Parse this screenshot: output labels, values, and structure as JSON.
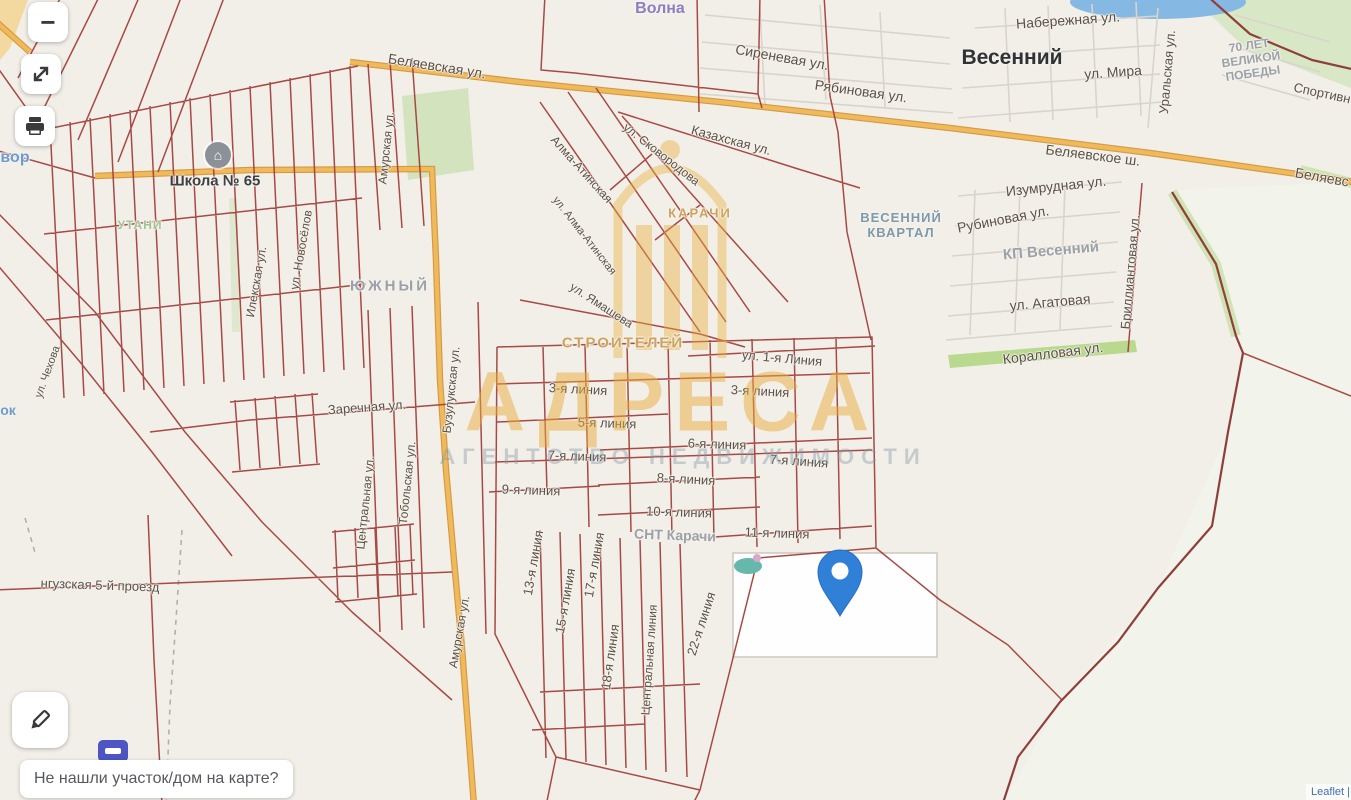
{
  "controls": {
    "zoom_out_label": "−",
    "icons": {
      "zoom_out": "minus-icon",
      "expand": "diagonal-resize-arrows-icon",
      "print": "printer-icon",
      "edit": "pencil-icon",
      "marker": "map-pin-icon",
      "school": "building-icon",
      "bus_stop": "bus-stop-icon"
    }
  },
  "footer": {
    "question": "Не нашли участок/дом на карте?"
  },
  "attribution": {
    "text": "Leaflet |"
  },
  "watermark": {
    "title": "АДРЕСА",
    "subtitle": "АГЕНТСТВО НЕДВИЖИМОСТИ"
  },
  "colors": {
    "pin": "#2f80d6",
    "road_primary": "#f0b95c",
    "parcel_line": "#a2403c",
    "boundary_line": "#8f3f3a",
    "water": "#85b8e2",
    "watermark_orange": "#e9ae38",
    "background": "#f2efe9"
  },
  "map": {
    "labels": [
      {
        "t": "Волна",
        "x": 660,
        "y": 9,
        "s": 16,
        "c": "purple",
        "n": "place-label"
      },
      {
        "t": "Весенний",
        "x": 1012,
        "y": 58,
        "s": 21,
        "c": "big",
        "n": "district-label"
      },
      {
        "t": "Набережная ул.",
        "x": 1068,
        "y": 20,
        "s": 14,
        "r": -4,
        "c": "st"
      },
      {
        "t": "ул. Мира",
        "x": 1113,
        "y": 72,
        "s": 14,
        "r": -4,
        "c": "st"
      },
      {
        "t": "Уральская ул.",
        "x": 1168,
        "y": 72,
        "s": 13,
        "r": -85,
        "c": "st"
      },
      {
        "t": "70 ЛЕТ\nВЕЛИКОЙ\nПОБЕДЫ",
        "x": 1251,
        "y": 60,
        "s": 12,
        "r": -8,
        "c": "gray",
        "n": "district-label"
      },
      {
        "t": "Спортивн",
        "x": 1322,
        "y": 94,
        "s": 13,
        "r": 12,
        "c": "st"
      },
      {
        "t": "Беляевская ул.",
        "x": 437,
        "y": 66,
        "s": 14,
        "r": 9,
        "c": "st"
      },
      {
        "t": "Сиреневая ул.",
        "x": 782,
        "y": 57,
        "s": 14,
        "r": 10,
        "c": "st"
      },
      {
        "t": "Рябиновая ул.",
        "x": 861,
        "y": 91,
        "s": 14,
        "r": 8,
        "c": "st"
      },
      {
        "t": "Казахская ул.",
        "x": 731,
        "y": 141,
        "s": 13,
        "r": 15,
        "c": "st"
      },
      {
        "t": "ул. Сковородова",
        "x": 661,
        "y": 155,
        "s": 12,
        "r": 38,
        "c": "st"
      },
      {
        "t": "Алма-Атинская",
        "x": 581,
        "y": 170,
        "s": 12,
        "r": 48,
        "c": "st"
      },
      {
        "t": "ул. Алма-Атинская",
        "x": 584,
        "y": 236,
        "s": 11,
        "r": 52,
        "c": "st"
      },
      {
        "t": "Беляевское ш.",
        "x": 1093,
        "y": 155,
        "s": 14,
        "r": 7,
        "c": "st"
      },
      {
        "t": "Беляевс",
        "x": 1322,
        "y": 177,
        "s": 14,
        "r": 10,
        "c": "st"
      },
      {
        "t": "Изумрудная ул.",
        "x": 1056,
        "y": 186,
        "s": 14,
        "r": -6,
        "c": "st"
      },
      {
        "t": "Рубиновая ул.",
        "x": 1003,
        "y": 219,
        "s": 14,
        "r": -11,
        "c": "st"
      },
      {
        "t": "КП Весенний",
        "x": 1051,
        "y": 251,
        "s": 15,
        "r": -5,
        "c": "gray",
        "n": "district-label"
      },
      {
        "t": "Бриллиантовая ул.",
        "x": 1131,
        "y": 272,
        "s": 13,
        "r": -85,
        "c": "st"
      },
      {
        "t": "ул. Агатовая",
        "x": 1050,
        "y": 302,
        "s": 14,
        "r": -5,
        "c": "st"
      },
      {
        "t": "Коралловая ул.",
        "x": 1053,
        "y": 353,
        "s": 14,
        "r": -7,
        "c": "st"
      },
      {
        "t": "ВЕСЕННИЙ\nКВАРТАЛ",
        "x": 901,
        "y": 226,
        "s": 13,
        "c": "teal",
        "n": "district-label"
      },
      {
        "t": "КАРАЧИ",
        "x": 700,
        "y": 214,
        "s": 13,
        "c": "tan",
        "ls": 2,
        "n": "district-label"
      },
      {
        "t": "СТРОИТЕЛЕЙ",
        "x": 623,
        "y": 343,
        "s": 15,
        "c": "tan",
        "ls": 2,
        "n": "district-label"
      },
      {
        "t": "Школа № 65",
        "x": 215,
        "y": 181,
        "s": 15,
        "c": "dark",
        "n": "poi-label"
      },
      {
        "t": "ЮЖНЫЙ",
        "x": 390,
        "y": 286,
        "s": 15,
        "c": "gray",
        "ls": 3,
        "n": "district-label"
      },
      {
        "t": "УТАНИ",
        "x": 140,
        "y": 226,
        "s": 12,
        "c": "green",
        "n": "area-label"
      },
      {
        "t": "вор",
        "x": 15,
        "y": 158,
        "s": 16,
        "c": "blue",
        "n": "place-label"
      },
      {
        "t": "ок",
        "x": 8,
        "y": 410,
        "s": 14,
        "c": "blue",
        "n": "place-label"
      },
      {
        "t": "ул. Ямашева",
        "x": 601,
        "y": 306,
        "s": 12,
        "r": 33,
        "c": "st"
      },
      {
        "t": "ул. 1-я Линия",
        "x": 782,
        "y": 359,
        "s": 13,
        "r": 5,
        "c": "st"
      },
      {
        "t": "3-я линия",
        "x": 578,
        "y": 390,
        "s": 13,
        "r": 3,
        "c": "st"
      },
      {
        "t": "3-я линия",
        "x": 760,
        "y": 392,
        "s": 13,
        "r": 3,
        "c": "st"
      },
      {
        "t": "5-я линия",
        "x": 607,
        "y": 424,
        "s": 13,
        "r": 2,
        "c": "st"
      },
      {
        "t": "6-я линия",
        "x": 717,
        "y": 445,
        "s": 13,
        "r": 2,
        "c": "st"
      },
      {
        "t": "7-я линия",
        "x": 577,
        "y": 457,
        "s": 13,
        "r": 2,
        "c": "st"
      },
      {
        "t": "7-я линия",
        "x": 799,
        "y": 462,
        "s": 13,
        "r": 4,
        "c": "st"
      },
      {
        "t": "8-я линия",
        "x": 686,
        "y": 480,
        "s": 13,
        "r": 3,
        "c": "st"
      },
      {
        "t": "9-я линия",
        "x": 531,
        "y": 491,
        "s": 13,
        "r": 2,
        "c": "st"
      },
      {
        "t": "10-я линия",
        "x": 679,
        "y": 513,
        "s": 13,
        "r": 2,
        "c": "st"
      },
      {
        "t": "СНТ Карачи",
        "x": 675,
        "y": 535,
        "s": 14,
        "r": 2,
        "c": "gray",
        "n": "district-label"
      },
      {
        "t": "11-я линия",
        "x": 777,
        "y": 534,
        "s": 13,
        "r": 2,
        "c": "st"
      },
      {
        "t": "13-я линия",
        "x": 534,
        "y": 563,
        "s": 13,
        "r": -80,
        "c": "st"
      },
      {
        "t": "15-я линия",
        "x": 566,
        "y": 601,
        "s": 13,
        "r": -80,
        "c": "st"
      },
      {
        "t": "17-я линия",
        "x": 595,
        "y": 565,
        "s": 13,
        "r": -80,
        "c": "st"
      },
      {
        "t": "18-я линия",
        "x": 611,
        "y": 657,
        "s": 13,
        "r": -82,
        "c": "st"
      },
      {
        "t": "Центральная линия",
        "x": 650,
        "y": 660,
        "s": 12,
        "r": -86,
        "c": "st"
      },
      {
        "t": "22-я линия",
        "x": 702,
        "y": 624,
        "s": 13,
        "r": -72,
        "c": "st"
      },
      {
        "t": "Заречная ул.",
        "x": 367,
        "y": 408,
        "s": 13,
        "r": -4,
        "c": "st"
      },
      {
        "t": "Центральная ул.",
        "x": 366,
        "y": 503,
        "s": 12,
        "r": -84,
        "c": "st"
      },
      {
        "t": "Тобольская ул.",
        "x": 408,
        "y": 483,
        "s": 12,
        "r": -84,
        "c": "st"
      },
      {
        "t": "Бузулукская ул.",
        "x": 452,
        "y": 390,
        "s": 12,
        "r": -84,
        "c": "st"
      },
      {
        "t": "Илекская ул.",
        "x": 257,
        "y": 282,
        "s": 12,
        "r": -80,
        "c": "st"
      },
      {
        "t": "ул. Новосёлов",
        "x": 302,
        "y": 250,
        "s": 12,
        "r": -80,
        "c": "st"
      },
      {
        "t": "Амурская ул.",
        "x": 387,
        "y": 148,
        "s": 12,
        "r": -84,
        "c": "st"
      },
      {
        "t": "Амурская ул.",
        "x": 460,
        "y": 632,
        "s": 12,
        "r": -80,
        "c": "st"
      },
      {
        "t": "нгузская 5-й проезд",
        "x": 100,
        "y": 586,
        "s": 13,
        "r": 2,
        "c": "st"
      },
      {
        "t": "ул. Чехова",
        "x": 48,
        "y": 372,
        "s": 11,
        "r": -70,
        "c": "st"
      }
    ]
  }
}
